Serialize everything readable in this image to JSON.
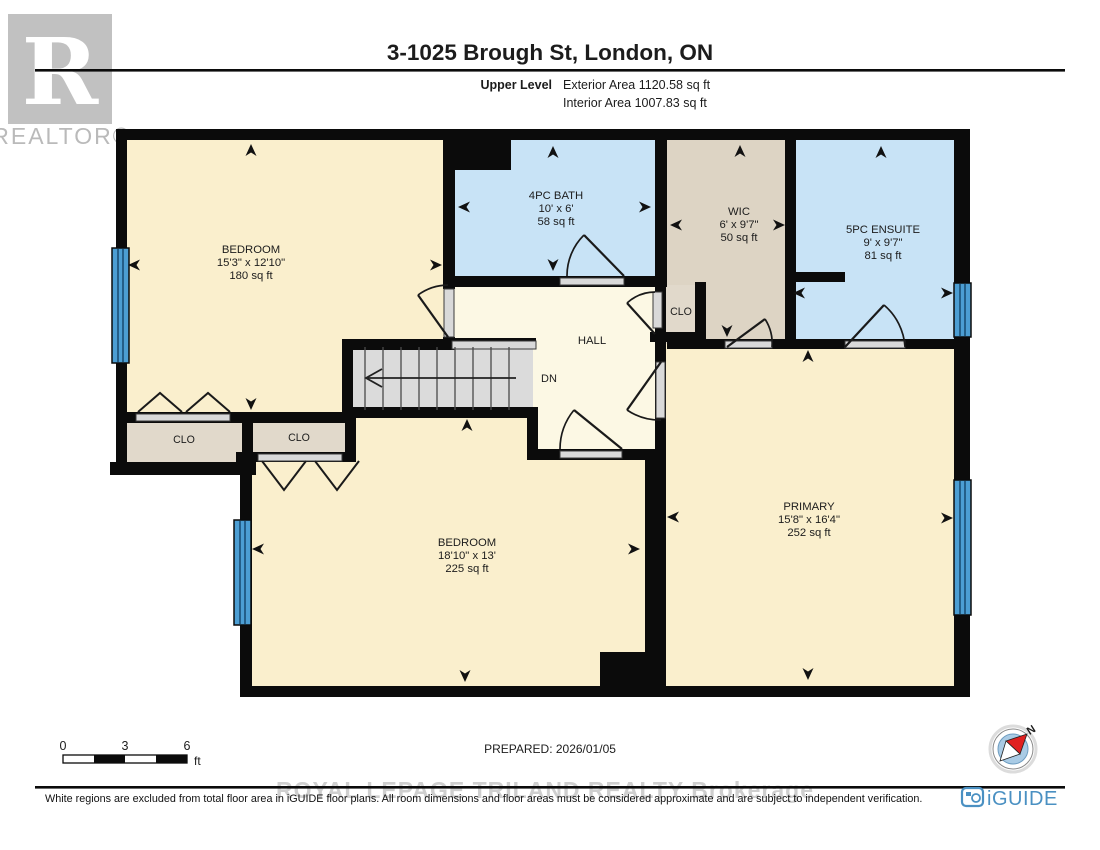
{
  "header": {
    "title": "3-1025 Brough St, London, ON",
    "level_label": "Upper Level",
    "exterior_area": "Exterior Area 1120.58 sq ft",
    "interior_area": "Interior Area 1007.83 sq ft",
    "realtor_logo_letter": "R",
    "realtor_logo_text": "REALTOR®"
  },
  "rooms": [
    {
      "id": "bedroom-1",
      "name": "BEDROOM",
      "dims": "15'3\" x 12'10\"",
      "area": "180 sq ft"
    },
    {
      "id": "bath-4pc",
      "name": "4PC BATH",
      "dims": "10' x 6'",
      "area": "58 sq ft"
    },
    {
      "id": "wic",
      "name": "WIC",
      "dims": "6' x 9'7\"",
      "area": "50 sq ft"
    },
    {
      "id": "ensuite-5pc",
      "name": "5PC ENSUITE",
      "dims": "9' x 9'7\"",
      "area": "81 sq ft"
    },
    {
      "id": "bedroom-2",
      "name": "BEDROOM",
      "dims": "18'10\" x 13'",
      "area": "225 sq ft"
    },
    {
      "id": "primary",
      "name": "PRIMARY",
      "dims": "15'8\" x 16'4\"",
      "area": "252 sq ft"
    }
  ],
  "labels": {
    "hall": "HALL",
    "closet": "CLO",
    "down": "DN",
    "north": "N"
  },
  "scale_bar": {
    "ticks": [
      "0",
      "3",
      "6"
    ],
    "unit": "ft"
  },
  "footer": {
    "prepared": "PREPARED: 2026/01/05",
    "watermark": "ROYAL LEPAGE TRILAND REALTY  Brokerage",
    "disclaimer": "White regions are excluded from total floor area in iGUIDE floor plans. All room dimensions and floor areas must be considered approximate and are subject to independent verification.",
    "brand": "iGUIDE"
  },
  "colors": {
    "room_cream": "#faefcd",
    "hall_pale": "#fcf8e4",
    "wet_room_blue": "#c8e3f6",
    "closet_tan": "#ddd4c4",
    "window_blue": "#4c9ed3",
    "stairs_gray": "#dbdbdb",
    "wall_black": "#0b0b0b",
    "brand_blue": "#4a90c2",
    "compass_red": "#e02020",
    "watermark_gray": "#c7c7c7"
  }
}
